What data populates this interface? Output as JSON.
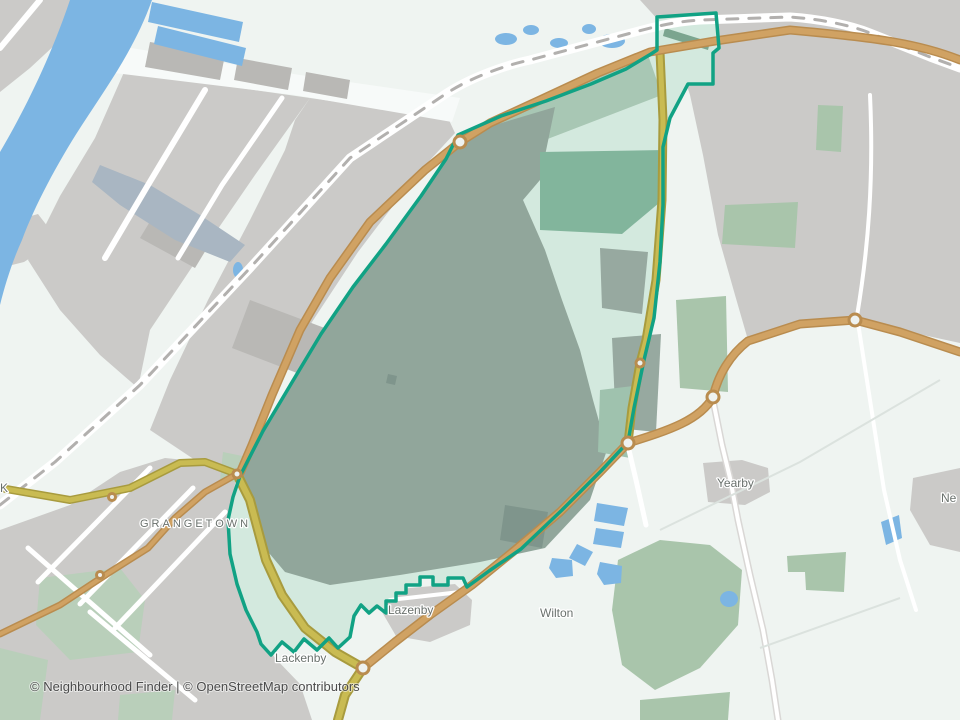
{
  "map": {
    "type": "neighbourhood-boundary-map",
    "attribution": "© Neighbourhood Finder | © OpenStreetMap contributors",
    "labels": {
      "grangetown": "GRANGETOWN",
      "lazenby": "Lazenby",
      "lackenby": "Lackenby",
      "wilton": "Wilton",
      "yearby": "Yearby",
      "edge_left_partial": "K",
      "edge_right_partial": "Ne"
    },
    "colors": {
      "land": "#eff4f1",
      "water": "#7cb5e3",
      "industrial": "#cbcac8",
      "building": "#b9b8b5",
      "dock_slate": "#a9b6c2",
      "urban_green": "#b9cfba",
      "woodland": "#a9c5ab",
      "interior_mint": "#d3e9de",
      "interior_works": "#91a69b",
      "interior_green": "#82b59c",
      "interior_dark": "#97a9a0",
      "boundary": "#11a284",
      "road_primary": "#d0a263",
      "road_primary_casing": "#b98c4f",
      "road_secondary": "#c9bb52",
      "road_secondary_casing": "#a89b3e",
      "road_white": "#ffffff",
      "railway": "#b2b0ae",
      "label": "#6a716d",
      "attribution": "#4b4b4b"
    }
  }
}
